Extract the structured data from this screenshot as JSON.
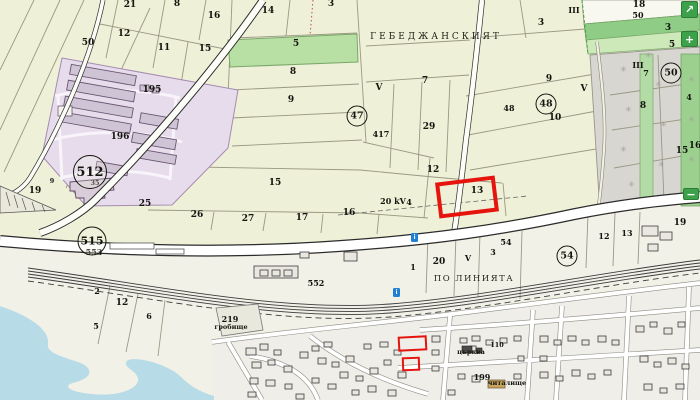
{
  "map": {
    "road_name": "ГЕБЕДЖАНСКИЯТ",
    "area_name": "ПО ЛИНИЯТА",
    "labels": [
      {
        "t": "21",
        "x": 130,
        "y": 5,
        "c": "p"
      },
      {
        "t": "8",
        "x": 177,
        "y": 4,
        "c": "p"
      },
      {
        "t": "16",
        "x": 214,
        "y": 16,
        "c": "p"
      },
      {
        "t": "50",
        "x": 88,
        "y": 43,
        "c": "p"
      },
      {
        "t": "12",
        "x": 124,
        "y": 34,
        "c": "p"
      },
      {
        "t": "11",
        "x": 164,
        "y": 48,
        "c": "p"
      },
      {
        "t": "15",
        "x": 205,
        "y": 49,
        "c": "p"
      },
      {
        "t": "14",
        "x": 268,
        "y": 11,
        "c": "p"
      },
      {
        "t": "3",
        "x": 331,
        "y": 4,
        "c": "p"
      },
      {
        "t": "5",
        "x": 296,
        "y": 44,
        "c": "p"
      },
      {
        "t": "8",
        "x": 293,
        "y": 72,
        "c": "p"
      },
      {
        "t": "9",
        "x": 291,
        "y": 100,
        "c": "p"
      },
      {
        "t": "III",
        "x": 574,
        "y": 10,
        "c": "p2"
      },
      {
        "t": "3",
        "x": 541,
        "y": 23,
        "c": "p"
      },
      {
        "t": "18",
        "x": 639,
        "y": 5,
        "c": "p"
      },
      {
        "t": "50",
        "x": 638,
        "y": 15,
        "c": "p2"
      },
      {
        "t": "3",
        "x": 668,
        "y": 28,
        "c": "p"
      },
      {
        "t": "5",
        "x": 672,
        "y": 45,
        "c": "p"
      },
      {
        "t": "III",
        "x": 638,
        "y": 65,
        "c": "p2"
      },
      {
        "t": "7",
        "x": 646,
        "y": 73,
        "c": "p2"
      },
      {
        "t": "9",
        "x": 549,
        "y": 79,
        "c": "p"
      },
      {
        "t": "V",
        "x": 584,
        "y": 89,
        "c": "p"
      },
      {
        "t": "48",
        "x": 509,
        "y": 108,
        "c": "p2"
      },
      {
        "t": "10",
        "x": 555,
        "y": 118,
        "c": "p"
      },
      {
        "t": "8",
        "x": 643,
        "y": 106,
        "c": "p"
      },
      {
        "t": "4",
        "x": 689,
        "y": 97,
        "c": "p2"
      },
      {
        "t": "15",
        "x": 682,
        "y": 151,
        "c": "p"
      },
      {
        "t": "16",
        "x": 695,
        "y": 146,
        "c": "p"
      },
      {
        "t": "7",
        "x": 425,
        "y": 81,
        "c": "p"
      },
      {
        "t": "V",
        "x": 379,
        "y": 88,
        "c": "p"
      },
      {
        "t": "417",
        "x": 381,
        "y": 134,
        "c": "p2"
      },
      {
        "t": "29",
        "x": 429,
        "y": 127,
        "c": "p"
      },
      {
        "t": "12",
        "x": 433,
        "y": 170,
        "c": "p"
      },
      {
        "t": "13",
        "x": 477,
        "y": 191,
        "c": "p"
      },
      {
        "t": "20 kV",
        "x": 393,
        "y": 201,
        "c": "p2"
      },
      {
        "t": "4",
        "x": 409,
        "y": 202,
        "c": "p2"
      },
      {
        "t": "15",
        "x": 275,
        "y": 183,
        "c": "p"
      },
      {
        "t": "25",
        "x": 145,
        "y": 204,
        "c": "p"
      },
      {
        "t": "26",
        "x": 197,
        "y": 215,
        "c": "p"
      },
      {
        "t": "27",
        "x": 248,
        "y": 219,
        "c": "p"
      },
      {
        "t": "17",
        "x": 302,
        "y": 218,
        "c": "p"
      },
      {
        "t": "16",
        "x": 349,
        "y": 213,
        "c": "p"
      },
      {
        "t": "195",
        "x": 152,
        "y": 90,
        "c": "p"
      },
      {
        "t": "196",
        "x": 120,
        "y": 137,
        "c": "p"
      },
      {
        "t": "19",
        "x": 35,
        "y": 191,
        "c": "p"
      },
      {
        "t": "9",
        "x": 52,
        "y": 181,
        "c": "tiny"
      },
      {
        "t": "35",
        "x": 95,
        "y": 183,
        "c": "tiny"
      },
      {
        "t": "553",
        "x": 94,
        "y": 252,
        "c": "p2"
      },
      {
        "t": "2",
        "x": 97,
        "y": 291,
        "c": "p2"
      },
      {
        "t": "12",
        "x": 122,
        "y": 303,
        "c": "p"
      },
      {
        "t": "5",
        "x": 96,
        "y": 326,
        "c": "p2"
      },
      {
        "t": "6",
        "x": 149,
        "y": 316,
        "c": "p2"
      },
      {
        "t": "219",
        "x": 230,
        "y": 319,
        "c": "p2"
      },
      {
        "t": "гробище",
        "x": 231,
        "y": 327,
        "c": "tiny"
      },
      {
        "t": "552",
        "x": 316,
        "y": 283,
        "c": "p2"
      },
      {
        "t": "1",
        "x": 413,
        "y": 267,
        "c": "p2"
      },
      {
        "t": "20",
        "x": 439,
        "y": 262,
        "c": "p"
      },
      {
        "t": "V",
        "x": 468,
        "y": 258,
        "c": "p2"
      },
      {
        "t": "3",
        "x": 493,
        "y": 252,
        "c": "p2"
      },
      {
        "t": "54",
        "x": 506,
        "y": 242,
        "c": "p2"
      },
      {
        "t": "12",
        "x": 604,
        "y": 236,
        "c": "p2"
      },
      {
        "t": "13",
        "x": 627,
        "y": 233,
        "c": "p2"
      },
      {
        "t": "19",
        "x": 680,
        "y": 223,
        "c": "p"
      },
      {
        "t": "110",
        "x": 497,
        "y": 345,
        "c": "tiny"
      },
      {
        "t": "църква",
        "x": 471,
        "y": 352,
        "c": "tiny"
      },
      {
        "t": "199",
        "x": 482,
        "y": 377,
        "c": "p2"
      },
      {
        "t": "читалище",
        "x": 507,
        "y": 383,
        "c": "tiny"
      },
      {
        "t": "ПО ЛИНИЯТА",
        "x": 474,
        "y": 279,
        "c": "area"
      },
      {
        "t": "ГЕБЕДЖАНСКИЯТ",
        "x": 436,
        "y": 37,
        "c": "name"
      }
    ],
    "circles": [
      {
        "t": "512",
        "x": 90,
        "y": 172,
        "s": "c-lg"
      },
      {
        "t": "515",
        "x": 92,
        "y": 241,
        "s": "c-md"
      },
      {
        "t": "47",
        "x": 357,
        "y": 116,
        "s": "c-sm"
      },
      {
        "t": "48",
        "x": 546,
        "y": 104,
        "s": "c-sm"
      },
      {
        "t": "50",
        "x": 671,
        "y": 73,
        "s": "c-sm"
      },
      {
        "t": "54",
        "x": 567,
        "y": 256,
        "s": "c-sm"
      }
    ],
    "selection": {
      "parcel": "13",
      "color": "#e5150e",
      "rects": [
        {
          "x": 437,
          "y": 179,
          "w": 60,
          "h": 36,
          "r": -7,
          "b": 4
        },
        {
          "x": 398,
          "y": 336,
          "w": 29,
          "h": 15,
          "r": -3,
          "b": 2
        },
        {
          "x": 402,
          "y": 357,
          "w": 18,
          "h": 14,
          "r": -2,
          "b": 2
        }
      ]
    },
    "poi": {
      "color": "#1f7fd4",
      "glyph": "i",
      "items": [
        {
          "x": 411,
          "y": 233
        },
        {
          "x": 393,
          "y": 288
        }
      ]
    },
    "controls": {
      "color": "#3da14c",
      "items": [
        {
          "id": "fullscreen",
          "glyph": "↗",
          "x": 681,
          "y": 1,
          "w": 17,
          "h": 17
        },
        {
          "id": "zoom-in",
          "glyph": "+",
          "x": 681,
          "y": 31,
          "w": 17,
          "h": 16
        },
        {
          "id": "zoom-out",
          "glyph": "−",
          "x": 683,
          "y": 188,
          "w": 16,
          "h": 12
        }
      ]
    },
    "symbols": {
      "orchard": "✳"
    },
    "colors": {
      "farmland": "#eff0d8",
      "green_parcel": "#b9e0a4",
      "green_strip": "#9cd08f",
      "urban_gray": "#d7d6d1",
      "industrial_pink": "#e7dcec",
      "water": "#b7dbe7",
      "road_fill": "#ffffff"
    }
  }
}
